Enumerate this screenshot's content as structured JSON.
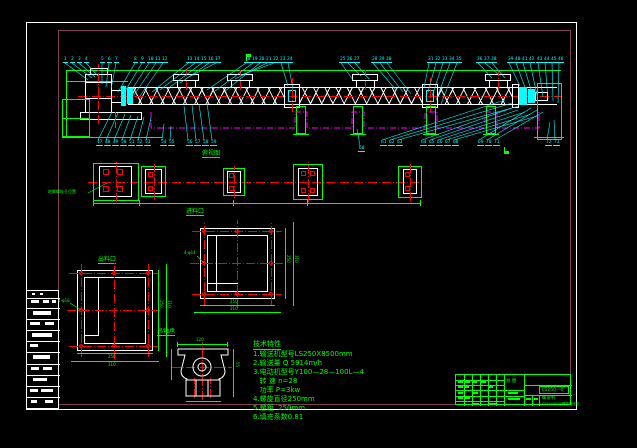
{
  "sheet": {
    "colors": {
      "cyan": "#00ffff",
      "green": "#00ff00",
      "red": "#ff0000",
      "magenta": "#ff00ff",
      "white": "#ffffff",
      "frame": "#804050"
    }
  },
  "titles": {
    "plan_view": "俯视图",
    "inlet": "进料口",
    "outlet": "出料口",
    "hanger_bearing": "吊轴承",
    "anchor_bolt_note": "地脚螺栓孔位置"
  },
  "notes": {
    "heading": "技术特性",
    "lines": [
      "1.输送机型号LS250X8500mm",
      "2.输送量 Q 5914m/h",
      "3.电动机型号Y100—28—100L—4",
      "   转 速 n=28",
      "   功率 P=3kw",
      "4.螺旋直径250mm",
      "5.螺距  250mm",
      "6.填充系数0.81"
    ]
  },
  "dims": {
    "inlet_leader": "4-φ14",
    "inlet_w1": "250",
    "inlet_w2": "310",
    "inlet_h1": "250",
    "inlet_h2": "310",
    "outlet_leader": "4-φ18",
    "outlet_w1": "250",
    "outlet_w2": "310",
    "outlet_h1": "250",
    "outlet_h2": "310",
    "bearing_w": "120",
    "bearing_h": "55"
  },
  "titleblock": {
    "center": "总 图",
    "dwg_no": "LS250—0",
    "product": "螺旋机",
    "subtitle": "LS250x8500螺旋输送机"
  },
  "part_labels_top": [
    {
      "n": "1",
      "x": 63,
      "tx": 88,
      "ty": 80
    },
    {
      "n": "2",
      "x": 70,
      "tx": 92,
      "ty": 78
    },
    {
      "n": "3",
      "x": 77,
      "tx": 95,
      "ty": 77
    },
    {
      "n": "4",
      "x": 84,
      "tx": 98,
      "ty": 76
    },
    {
      "n": "5",
      "x": 100,
      "tx": 102,
      "ty": 84
    },
    {
      "n": "6",
      "x": 107,
      "tx": 106,
      "ty": 87
    },
    {
      "n": "7",
      "x": 114,
      "tx": 111,
      "ty": 89
    },
    {
      "n": "8",
      "x": 133,
      "tx": 118,
      "ty": 92
    },
    {
      "n": "9",
      "x": 140,
      "tx": 124,
      "ty": 93
    },
    {
      "n": "10",
      "x": 147,
      "tx": 129,
      "ty": 94
    },
    {
      "n": "11",
      "x": 154,
      "tx": 134,
      "ty": 95
    },
    {
      "n": "12",
      "x": 161,
      "tx": 140,
      "ty": 96
    },
    {
      "n": "13",
      "x": 186,
      "tx": 152,
      "ty": 92
    },
    {
      "n": "14",
      "x": 193,
      "tx": 160,
      "ty": 90
    },
    {
      "n": "15",
      "x": 200,
      "tx": 170,
      "ty": 87
    },
    {
      "n": "16",
      "x": 207,
      "tx": 180,
      "ty": 83
    },
    {
      "n": "17",
      "x": 214,
      "tx": 187,
      "ty": 78
    },
    {
      "n": "18",
      "x": 244,
      "tx": 207,
      "ty": 90
    },
    {
      "n": "19",
      "x": 251,
      "tx": 215,
      "ty": 91
    },
    {
      "n": "20",
      "x": 258,
      "tx": 224,
      "ty": 92
    },
    {
      "n": "21",
      "x": 265,
      "tx": 235,
      "ty": 79
    },
    {
      "n": "22",
      "x": 272,
      "tx": 241,
      "ty": 75
    },
    {
      "n": "23",
      "x": 279,
      "tx": 288,
      "ty": 86
    },
    {
      "n": "24",
      "x": 286,
      "tx": 293,
      "ty": 89
    },
    {
      "n": "25",
      "x": 339,
      "tx": 353,
      "ty": 80
    },
    {
      "n": "26",
      "x": 346,
      "tx": 361,
      "ty": 76
    },
    {
      "n": "27",
      "x": 353,
      "tx": 369,
      "ty": 79
    },
    {
      "n": "28",
      "x": 371,
      "tx": 396,
      "ty": 90
    },
    {
      "n": "29",
      "x": 378,
      "tx": 403,
      "ty": 92
    },
    {
      "n": "30",
      "x": 385,
      "tx": 411,
      "ty": 94
    },
    {
      "n": "31",
      "x": 427,
      "tx": 424,
      "ty": 88
    },
    {
      "n": "32",
      "x": 434,
      "tx": 428,
      "ty": 92
    },
    {
      "n": "33",
      "x": 441,
      "tx": 432,
      "ty": 96
    },
    {
      "n": "34",
      "x": 448,
      "tx": 436,
      "ty": 100
    },
    {
      "n": "35",
      "x": 455,
      "tx": 441,
      "ty": 104
    },
    {
      "n": "36",
      "x": 476,
      "tx": 492,
      "ty": 78
    },
    {
      "n": "37",
      "x": 483,
      "tx": 498,
      "ty": 74
    },
    {
      "n": "38",
      "x": 490,
      "tx": 505,
      "ty": 78
    },
    {
      "n": "39",
      "x": 507,
      "tx": 520,
      "ty": 86
    },
    {
      "n": "40",
      "x": 514,
      "tx": 526,
      "ty": 90
    },
    {
      "n": "41",
      "x": 521,
      "tx": 532,
      "ty": 93
    },
    {
      "n": "42",
      "x": 528,
      "tx": 537,
      "ty": 95
    },
    {
      "n": "43",
      "x": 536,
      "tx": 543,
      "ty": 97
    },
    {
      "n": "44",
      "x": 543,
      "tx": 548,
      "ty": 99
    },
    {
      "n": "45",
      "x": 550,
      "tx": 553,
      "ty": 101
    },
    {
      "n": "46",
      "x": 557,
      "tx": 558,
      "ty": 103
    }
  ],
  "part_labels_bottom": [
    {
      "n": "47",
      "x": 96,
      "tx": 112,
      "ty": 112
    },
    {
      "n": "48",
      "x": 104,
      "tx": 118,
      "ty": 113
    },
    {
      "n": "49",
      "x": 112,
      "tx": 125,
      "ty": 114
    },
    {
      "n": "50",
      "x": 120,
      "tx": 131,
      "ty": 115
    },
    {
      "n": "51",
      "x": 128,
      "tx": 138,
      "ty": 116
    },
    {
      "n": "52",
      "x": 136,
      "tx": 144,
      "ty": 117
    },
    {
      "n": "53",
      "x": 144,
      "tx": 151,
      "ty": 118
    },
    {
      "n": "54",
      "x": 160,
      "tx": 164,
      "ty": 124
    },
    {
      "n": "55",
      "x": 168,
      "tx": 171,
      "ty": 126
    },
    {
      "n": "56",
      "x": 186,
      "tx": 184,
      "ty": 106
    },
    {
      "n": "57",
      "x": 194,
      "tx": 192,
      "ty": 105
    },
    {
      "n": "58",
      "x": 202,
      "tx": 199,
      "ty": 104
    },
    {
      "n": "59",
      "x": 210,
      "tx": 207,
      "ty": 103
    },
    {
      "n": "60",
      "x": 358,
      "y": 146,
      "tx": 357,
      "ty": 129
    },
    {
      "n": "61",
      "x": 380,
      "tx": 505,
      "ty": 100
    },
    {
      "n": "62",
      "x": 388,
      "tx": 512,
      "ty": 103
    },
    {
      "n": "63",
      "x": 396,
      "tx": 519,
      "ty": 106
    },
    {
      "n": "64",
      "x": 420,
      "tx": 512,
      "ty": 108
    },
    {
      "n": "65",
      "x": 428,
      "tx": 518,
      "ty": 110
    },
    {
      "n": "66",
      "x": 436,
      "tx": 525,
      "ty": 112
    },
    {
      "n": "67",
      "x": 444,
      "tx": 531,
      "ty": 114
    },
    {
      "n": "68",
      "x": 452,
      "tx": 537,
      "ty": 116
    },
    {
      "n": "69",
      "x": 477,
      "tx": 531,
      "ty": 108
    },
    {
      "n": "70",
      "x": 485,
      "tx": 537,
      "ty": 110
    },
    {
      "n": "71",
      "x": 493,
      "tx": 543,
      "ty": 112
    },
    {
      "n": "72",
      "x": 545,
      "tx": 550,
      "ty": 122
    },
    {
      "n": "73",
      "x": 553,
      "tx": 554,
      "ty": 120
    }
  ]
}
